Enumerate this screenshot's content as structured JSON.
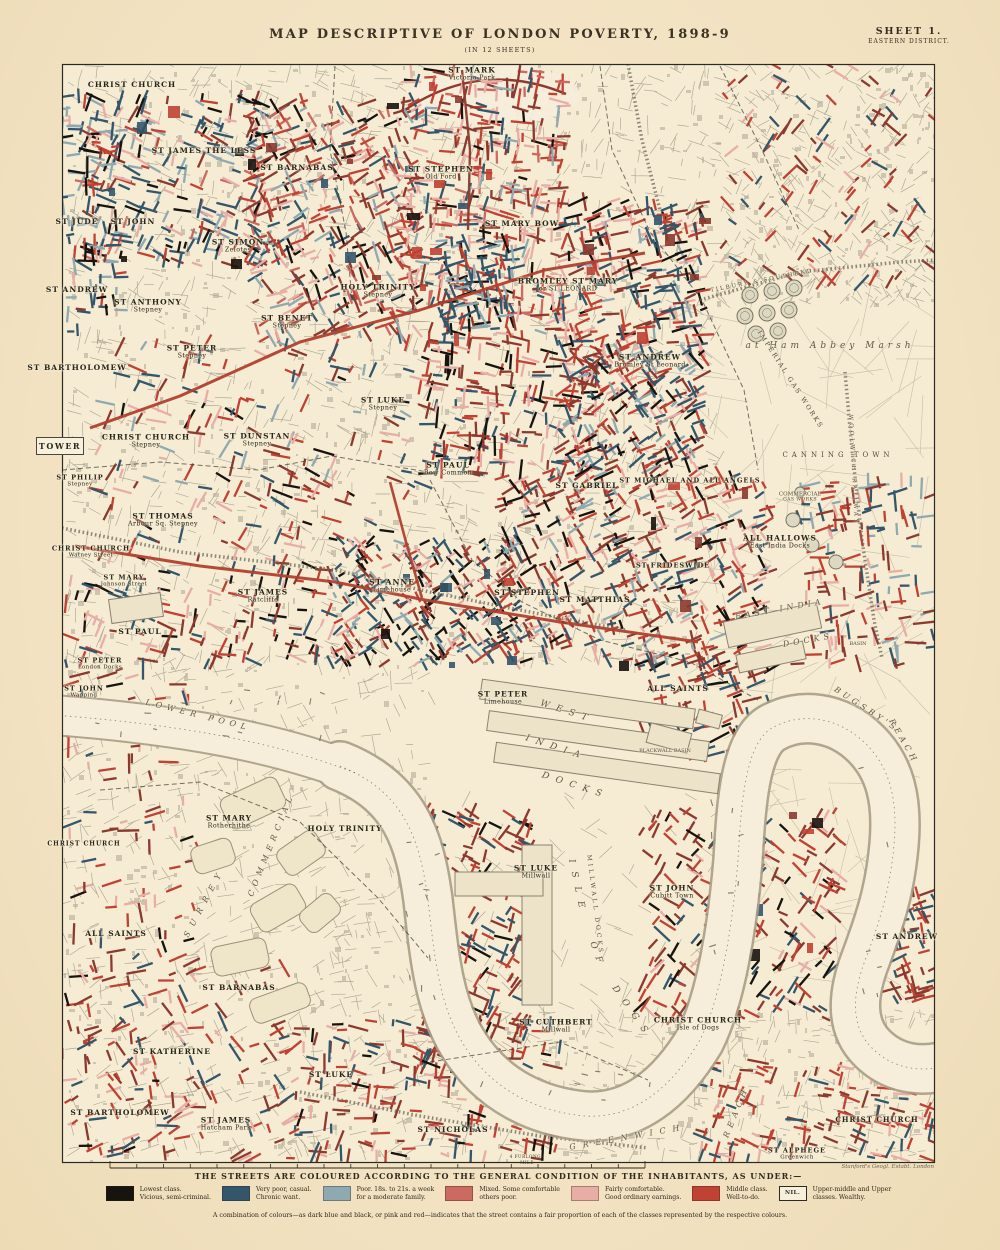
{
  "title_block": {
    "title": "MAP DESCRIPTIVE OF LONDON POVERTY, 1898-9",
    "subtitle": "(IN 12 SHEETS)",
    "sheet_number": "SHEET 1.",
    "sheet_district": "EASTERN DISTRICT."
  },
  "attribution": "Stanford's Geogl. Estabt. London",
  "adjacent_sheet_label": "TOWER",
  "scale_bar": {
    "top_label": "4 FURLONGS",
    "bottom_label": "MILE"
  },
  "legend": {
    "heading": "THE STREETS ARE COLOURED ACCORDING TO THE GENERAL CONDITION OF THE INHABITANTS, AS UNDER:—",
    "items": [
      {
        "color": "#17130e",
        "lines": [
          "Lowest class.",
          "Vicious, semi-criminal."
        ]
      },
      {
        "color": "#33566b",
        "lines": [
          "Very poor, casual.",
          "Chronic want."
        ]
      },
      {
        "color": "#8fa9b0",
        "lines": [
          "Poor. 18s. to 21s. a week",
          "for a moderate family."
        ]
      },
      {
        "color": "#cb6a60",
        "lines": [
          "Mixed. Some comfortable",
          "others poor."
        ]
      },
      {
        "color": "#e8aea6",
        "lines": [
          "Fairly comfortable.",
          "Good ordinary earnings."
        ]
      },
      {
        "color": "#c04233",
        "lines": [
          "Middle class.",
          "Well-to-do."
        ]
      },
      {
        "nil": true,
        "nil_label": "NIL.",
        "lines": [
          "Upper-middle and Upper",
          "classes.  Wealthy."
        ]
      }
    ],
    "note": "A combination of colours—as dark blue and black, or pink and red—indicates that the street contains a fair proportion of each of the classes represented by the respective colours."
  },
  "palette": {
    "paper": "#f3e3c4",
    "land": "#f6ecd4",
    "river": "#f6eedb",
    "river_edge": "#a89e85",
    "street_gray": "#a49e8b",
    "building": "#b3ac98",
    "field": "#b9b19b",
    "class_black": "#17130e",
    "class_dark_blue": "#33566b",
    "class_light_blue": "#8fa9b0",
    "class_mixed": "#cb6a60",
    "class_pink": "#e8aea6",
    "class_red": "#c04233",
    "class_maroon": "#8c3a2f",
    "arterial_red": "#b1402e",
    "railway": "#6b675a",
    "boundary": "#3c3a2e",
    "label_ink": "#27241a"
  },
  "map_labels": [
    {
      "t": "CHRIST CHURCH",
      "x": 132,
      "y": 85,
      "k": "parish"
    },
    {
      "t": "ST MARK",
      "s": "Victoria Park",
      "x": 472,
      "y": 74,
      "k": "parish"
    },
    {
      "t": "ST JAMES THE LESS",
      "x": 204,
      "y": 151,
      "k": "parish"
    },
    {
      "t": "ST BARNABAS",
      "x": 297,
      "y": 168,
      "k": "parish"
    },
    {
      "t": "ST STEPHEN",
      "s": "Old Ford",
      "x": 441,
      "y": 173,
      "k": "parish"
    },
    {
      "t": "ST JUDE",
      "x": 77,
      "y": 222,
      "k": "parish"
    },
    {
      "t": "ST JOHN",
      "x": 133,
      "y": 222,
      "k": "parish"
    },
    {
      "t": "ST SIMON",
      "s": "Zelotes",
      "x": 238,
      "y": 246,
      "k": "parish"
    },
    {
      "t": "ST MARY BOW",
      "x": 522,
      "y": 224,
      "k": "parish"
    },
    {
      "t": "BROMLEY ST MARY",
      "s": "or ST LEONARD",
      "x": 568,
      "y": 285,
      "k": "parish"
    },
    {
      "t": "ST ANDREW",
      "x": 77,
      "y": 290,
      "k": "parish"
    },
    {
      "t": "ST ANTHONY",
      "s": "Stepney",
      "x": 148,
      "y": 306,
      "k": "parish"
    },
    {
      "t": "HOLY TRINITY",
      "s": "Stepney",
      "x": 378,
      "y": 291,
      "k": "parish"
    },
    {
      "t": "ST BENET",
      "s": "Stepney",
      "x": 287,
      "y": 322,
      "k": "parish"
    },
    {
      "t": "ST PETER",
      "s": "Stepney",
      "x": 192,
      "y": 352,
      "k": "parish"
    },
    {
      "t": "ST ANDREW",
      "s": "Bromley St Leonard",
      "x": 650,
      "y": 361,
      "k": "parish"
    },
    {
      "t": "ST BARTHOLOMEW",
      "x": 77,
      "y": 368,
      "k": "parish"
    },
    {
      "t": "ST LUKE",
      "s": "Stepney",
      "x": 383,
      "y": 404,
      "k": "parish"
    },
    {
      "t": "CHRIST CHURCH",
      "s": "Stepney",
      "x": 146,
      "y": 441,
      "k": "parish"
    },
    {
      "t": "ST DUNSTAN",
      "s": "Stepney",
      "x": 257,
      "y": 440,
      "k": "parish"
    },
    {
      "t": "ST PAUL",
      "s": "Bow Common",
      "x": 448,
      "y": 469,
      "k": "parish"
    },
    {
      "t": "ST GABRIEL",
      "x": 587,
      "y": 486,
      "k": "parish"
    },
    {
      "t": "ST MICHAEL AND ALL ANGELS",
      "x": 690,
      "y": 481,
      "fs": 6.5,
      "k": "parish"
    },
    {
      "t": "ST PHILIP",
      "s": "Stepney",
      "x": 80,
      "y": 481,
      "fs": 6.5,
      "k": "parish"
    },
    {
      "t": "ST THOMAS",
      "s": "Arbour Sq. Stepney",
      "x": 163,
      "y": 520,
      "k": "parish"
    },
    {
      "t": "CHRIST CHURCH",
      "s": "Watney Street",
      "x": 91,
      "y": 552,
      "fs": 6.5,
      "k": "parish"
    },
    {
      "t": "ST MARY",
      "s": "Johnson Street",
      "x": 124,
      "y": 581,
      "fs": 6.5,
      "k": "parish"
    },
    {
      "t": "ALL HALLOWS",
      "s": "East India Docks",
      "x": 780,
      "y": 542,
      "k": "parish"
    },
    {
      "t": "ST FRIDESWIDE",
      "x": 673,
      "y": 566,
      "fs": 6.5,
      "k": "parish"
    },
    {
      "t": "ST JAMES",
      "s": "Ratcliffe",
      "x": 263,
      "y": 596,
      "k": "parish"
    },
    {
      "t": "ST ANNE",
      "s": "Limehouse",
      "x": 392,
      "y": 586,
      "k": "parish"
    },
    {
      "t": "ST STEPHEN",
      "x": 527,
      "y": 593,
      "k": "parish"
    },
    {
      "t": "ST MATTHIAS",
      "x": 595,
      "y": 600,
      "k": "parish"
    },
    {
      "t": "ST PAUL",
      "x": 140,
      "y": 632,
      "k": "parish"
    },
    {
      "t": "ST PETER",
      "s": "London Docks",
      "x": 100,
      "y": 664,
      "fs": 6.5,
      "k": "parish"
    },
    {
      "t": "ST JOHN",
      "s": "Wapping",
      "x": 84,
      "y": 692,
      "fs": 6.5,
      "k": "parish"
    },
    {
      "t": "ST PETER",
      "s": "Limehouse",
      "x": 503,
      "y": 698,
      "k": "parish"
    },
    {
      "t": "ALL SAINTS",
      "x": 678,
      "y": 689,
      "k": "parish"
    },
    {
      "t": "ST MARY",
      "s": "Rotherhithe",
      "x": 229,
      "y": 822,
      "k": "parish"
    },
    {
      "t": "HOLY TRINITY",
      "x": 345,
      "y": 829,
      "k": "parish"
    },
    {
      "t": "CHRIST CHURCH",
      "x": 84,
      "y": 845,
      "fs": 6,
      "k": "parish"
    },
    {
      "t": "ALL SAINTS",
      "x": 116,
      "y": 934,
      "k": "parish"
    },
    {
      "t": "ST LUKE",
      "s": "Millwall",
      "x": 536,
      "y": 872,
      "k": "parish"
    },
    {
      "t": "ST JOHN",
      "s": "Cubitt Town",
      "x": 672,
      "y": 892,
      "k": "parish"
    },
    {
      "t": "ST BARNABAS",
      "x": 239,
      "y": 988,
      "k": "parish"
    },
    {
      "t": "ST ANDREW",
      "x": 907,
      "y": 937,
      "k": "parish"
    },
    {
      "t": "ST CUTHBERT",
      "s": "Millwall",
      "x": 556,
      "y": 1026,
      "k": "parish"
    },
    {
      "t": "CHRIST CHURCH",
      "s": "Isle of Dogs",
      "x": 698,
      "y": 1024,
      "k": "parish"
    },
    {
      "t": "ST KATHERINE",
      "x": 172,
      "y": 1052,
      "k": "parish"
    },
    {
      "t": "ST LUKE",
      "x": 331,
      "y": 1075,
      "k": "parish"
    },
    {
      "t": "ST BARTHOLOMEW",
      "x": 120,
      "y": 1113,
      "k": "parish"
    },
    {
      "t": "ST JAMES",
      "s": "Hatcham Park",
      "x": 226,
      "y": 1124,
      "k": "parish"
    },
    {
      "t": "ST NICHOLAS",
      "x": 453,
      "y": 1130,
      "k": "parish"
    },
    {
      "t": "CHRIST CHURCH",
      "x": 877,
      "y": 1120,
      "fs": 7,
      "k": "parish"
    },
    {
      "t": "ST ALPHEGE",
      "s": "Greenwich",
      "x": 797,
      "y": 1154,
      "fs": 6.5,
      "k": "parish"
    },
    {
      "t": "LOWER POOL",
      "x": 198,
      "y": 716,
      "rot": 14,
      "ls": 5,
      "fs": 8,
      "k": "water"
    },
    {
      "t": "WEST",
      "x": 567,
      "y": 712,
      "rot": 18,
      "ls": 7,
      "fs": 9,
      "k": "water"
    },
    {
      "t": "INDIA",
      "x": 556,
      "y": 748,
      "rot": 18,
      "ls": 7,
      "fs": 9,
      "k": "water"
    },
    {
      "t": "DOCKS",
      "x": 575,
      "y": 786,
      "rot": 18,
      "ls": 7,
      "fs": 9,
      "k": "water"
    },
    {
      "t": "EAST INDIA",
      "x": 780,
      "y": 610,
      "rot": -10,
      "ls": 4,
      "fs": 8,
      "k": "water"
    },
    {
      "t": "DOCKS",
      "x": 808,
      "y": 641,
      "rot": -10,
      "ls": 4,
      "fs": 8,
      "k": "water"
    },
    {
      "t": "BASIN",
      "x": 858,
      "y": 645,
      "fs": 5,
      "k": "tiny"
    },
    {
      "t": "BLACKWALL BASIN",
      "x": 665,
      "y": 752,
      "fs": 5,
      "k": "tiny"
    },
    {
      "t": "ISLE",
      "x": 577,
      "y": 888,
      "rot": 78,
      "ls": 9,
      "fs": 9,
      "k": "water"
    },
    {
      "t": "OF",
      "x": 597,
      "y": 956,
      "rot": 70,
      "ls": 8,
      "fs": 9,
      "k": "water"
    },
    {
      "t": "DOGS",
      "x": 632,
      "y": 1013,
      "rot": 55,
      "ls": 9,
      "fs": 9,
      "k": "water"
    },
    {
      "t": "MILLWALL DOCKS",
      "x": 594,
      "y": 905,
      "rot": 83,
      "ls": 3,
      "fs": 6,
      "k": "area"
    },
    {
      "t": "BUGSBY'S",
      "x": 866,
      "y": 710,
      "rot": 33,
      "ls": 4,
      "fs": 8,
      "k": "water"
    },
    {
      "t": "REACH",
      "x": 903,
      "y": 742,
      "rot": 60,
      "ls": 4,
      "fs": 8,
      "k": "water"
    },
    {
      "t": "GREENWICH",
      "x": 628,
      "y": 1138,
      "rot": -10,
      "ls": 7,
      "fs": 8,
      "k": "water"
    },
    {
      "t": "REACH",
      "x": 737,
      "y": 1112,
      "rot": -68,
      "ls": 5,
      "fs": 8,
      "k": "water"
    },
    {
      "t": "SURREY",
      "x": 205,
      "y": 903,
      "rot": -62,
      "ls": 7,
      "fs": 8,
      "k": "water"
    },
    {
      "t": "COMMERCIAL",
      "x": 272,
      "y": 845,
      "rot": -68,
      "ls": 5,
      "fs": 8,
      "k": "water"
    },
    {
      "t": "at Ham Abbey Marsh",
      "x": 830,
      "y": 346,
      "ls": 4,
      "fs": 9,
      "k": "water"
    },
    {
      "t": "CANNING TOWN",
      "x": 838,
      "y": 456,
      "ls": 4,
      "fs": 7,
      "k": "area"
    },
    {
      "t": "IMPERIAL GAS WORKS",
      "x": 790,
      "y": 380,
      "rot": 57,
      "ls": 2,
      "fs": 6.5,
      "k": "area"
    },
    {
      "t": "COMMERCIAL",
      "s": "GAS WORKS",
      "x": 800,
      "y": 497,
      "fs": 5.5,
      "k": "area"
    },
    {
      "t": "TILBURY & SOUTHEND",
      "x": 762,
      "y": 281,
      "rot": -11,
      "ls": 2,
      "fs": 5.5,
      "k": "area"
    },
    {
      "t": "WOOLWICH RAILWAY",
      "x": 853,
      "y": 470,
      "rot": 87,
      "ls": 3,
      "fs": 5.5,
      "k": "area"
    }
  ]
}
